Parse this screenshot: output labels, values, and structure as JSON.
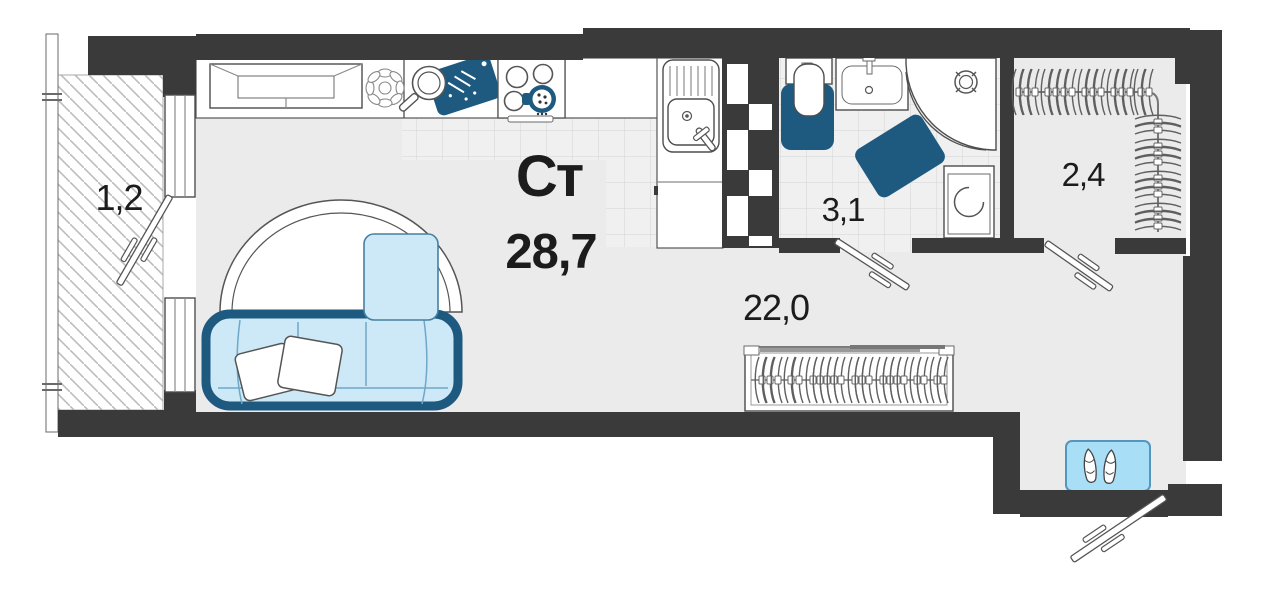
{
  "plan": {
    "unit_type_label": "Ст",
    "total_area": "28,7",
    "rooms": [
      {
        "name": "balcony",
        "area_label": "1,2"
      },
      {
        "name": "bathroom",
        "area_label": "3,1"
      },
      {
        "name": "living-kitchen",
        "area_label": "22,0"
      },
      {
        "name": "wardrobe-hall",
        "area_label": "2,4"
      }
    ],
    "colors": {
      "wall": "#3a3a3a",
      "floor": "#ebebeb",
      "accent_dark_blue": "#1e5a80",
      "accent_light_blue": "#cde9f8",
      "mat_blue": "#a9def7",
      "outline": "#4d4d4d",
      "text": "#1c1c1c"
    }
  }
}
